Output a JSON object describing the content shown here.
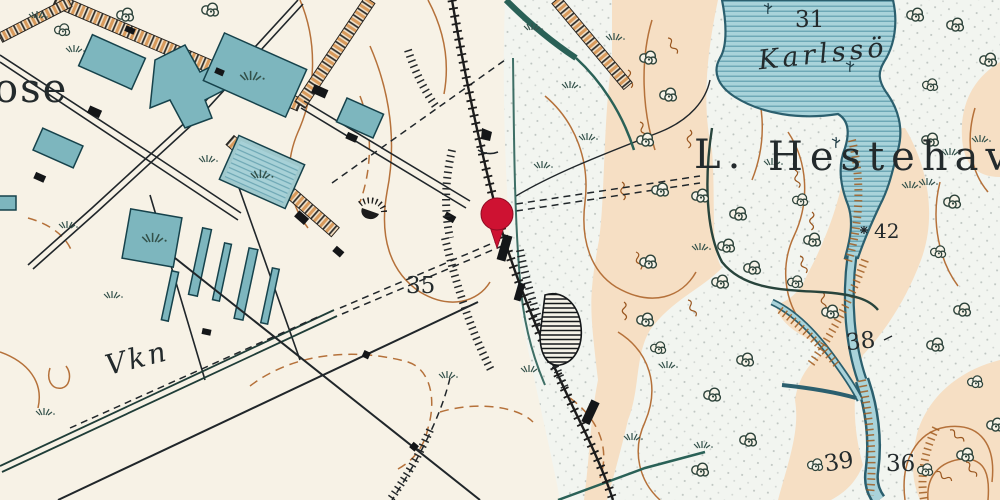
{
  "map": {
    "kind": "historical-topographic-map",
    "labels": {
      "town_partial": "ose",
      "lake_name": "Karlssö",
      "forest_prefix": "L.",
      "forest_name": "Hestehave",
      "farm_abbrev": "Vkn",
      "spot_31": "31",
      "spot_35": "35",
      "spot_38": "38",
      "spot_39": "39",
      "spot_42": "42",
      "spot_36": "36"
    },
    "marker": {
      "name": "red-map-pin",
      "color": "#ce1232"
    },
    "palette": {
      "paper": "#f7f2e6",
      "water_fill": "#a9d3da",
      "water_line": "#2b5f6e",
      "building_teal": "#7db6be",
      "contour_orange": "#b5713a",
      "terrain_peach": "#f6dfc4",
      "ink": "#20262a"
    }
  }
}
